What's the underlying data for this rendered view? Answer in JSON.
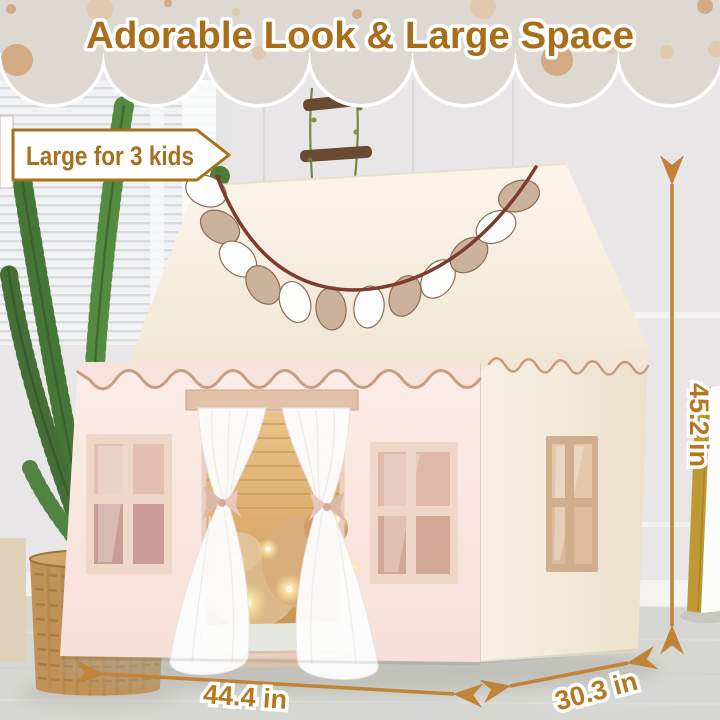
{
  "header": {
    "title": "Adorable Look & Large Space",
    "badge_label": "Large for 3 kids"
  },
  "annotations": {
    "height_label": "45.2 in",
    "width_label": "44.4 in",
    "depth_label": "30.3 in"
  },
  "colors": {
    "banner_bg": "#ded8d2",
    "banner_dot_tan": "#d2ab82",
    "banner_dot_light": "#e0c9ac",
    "accent_brown": "#a8701d",
    "dimension_text": "#b5781f",
    "arrow_color": "#c18336",
    "tent_front": "#fbeae5",
    "tent_side": "#f6efe3",
    "tent_roof": "#f8f1e4",
    "garland_rope": "#7e3b31",
    "flag_tan": "#cbb29a",
    "flag_white": "#fdfdfb",
    "interior_glow": "#eac488"
  }
}
